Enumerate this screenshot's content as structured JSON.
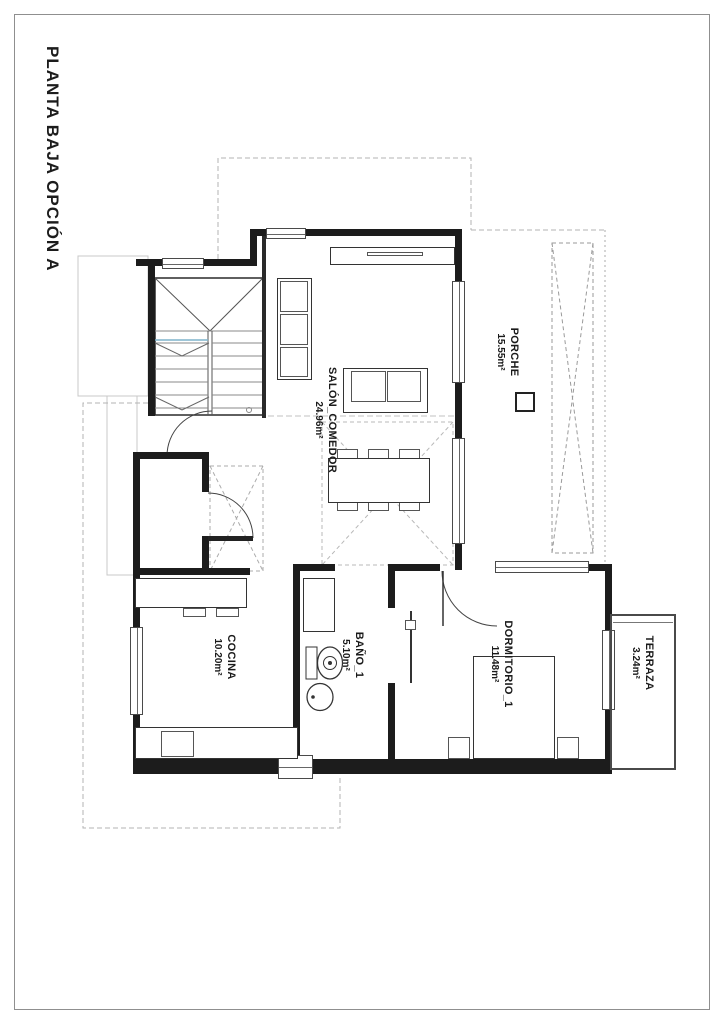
{
  "page": {
    "title": "PLANTA BAJA OPCIÓN A"
  },
  "rooms": [
    {
      "id": "salon",
      "name": "SALÓN_COMEDOR",
      "area": "24.96m²"
    },
    {
      "id": "porche",
      "name": "PORCHE",
      "area": "15.55m²"
    },
    {
      "id": "cocina",
      "name": "COCINA",
      "area": "10.20m²"
    },
    {
      "id": "bano",
      "name": "BAÑO_1",
      "area": "5.10m²"
    },
    {
      "id": "dormitorio",
      "name": "DORMITORIO_1",
      "area": "11.48m²"
    },
    {
      "id": "terraza",
      "name": "TERRAZA",
      "area": "3.24m²"
    }
  ],
  "colors": {
    "wall": "#1c1c1c",
    "dashed": "#b3b3b3",
    "accent_blue": "#7fb3cc",
    "sheet_border": "#8f8f8f"
  }
}
